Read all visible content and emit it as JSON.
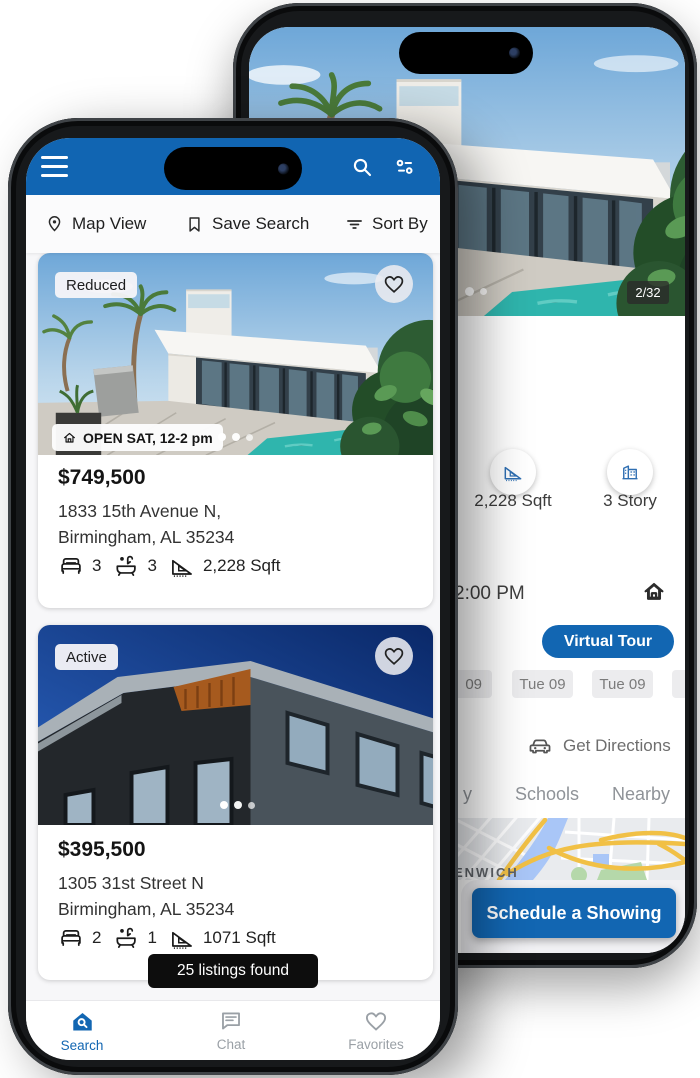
{
  "colors": {
    "header_blue": "#1165b2",
    "accent_blue": "#1266b2",
    "toast_bg": "#0d0d0d",
    "chip_bg": "#ececee",
    "badge_bg": "#f5f4f8",
    "nav_inactive": "#9aa0a6"
  },
  "front": {
    "toolbar": {
      "map_view": "Map View",
      "save_search": "Save Search",
      "sort_by": "Sort By"
    },
    "listings": [
      {
        "badge": "Reduced",
        "open_house": "OPEN SAT, 12-2 pm",
        "price": "$749,500",
        "address_line1": "1833 15th Avenue N,",
        "address_line2": "Birmingham, AL 35234",
        "beds": "3",
        "baths": "3",
        "sqft": "2,228 Sqft"
      },
      {
        "badge": "Active",
        "price": "$395,500",
        "address_line1": "1305 31st Street N",
        "address_line2": "Birmingham, AL 35234",
        "beds": "2",
        "baths": "1",
        "sqft": "1071 Sqft"
      }
    ],
    "toast": "25 listings found",
    "nav": {
      "search": "Search",
      "chat": "Chat",
      "favorites": "Favorites"
    }
  },
  "back": {
    "photo_counter": "2/32",
    "stats": {
      "sqft": "2,228 Sqft",
      "story": "3 Story"
    },
    "time": "2:00 PM",
    "virtual_tour": "Virtual Tour",
    "chips": [
      "09",
      "Tue 09",
      "Tue 09"
    ],
    "get_directions": "Get Directions",
    "tabs": {
      "fragment": "y",
      "schools": "Schools",
      "nearby": "Nearby"
    },
    "map_label": "ENWICH",
    "schedule": "Schedule a Showing"
  }
}
